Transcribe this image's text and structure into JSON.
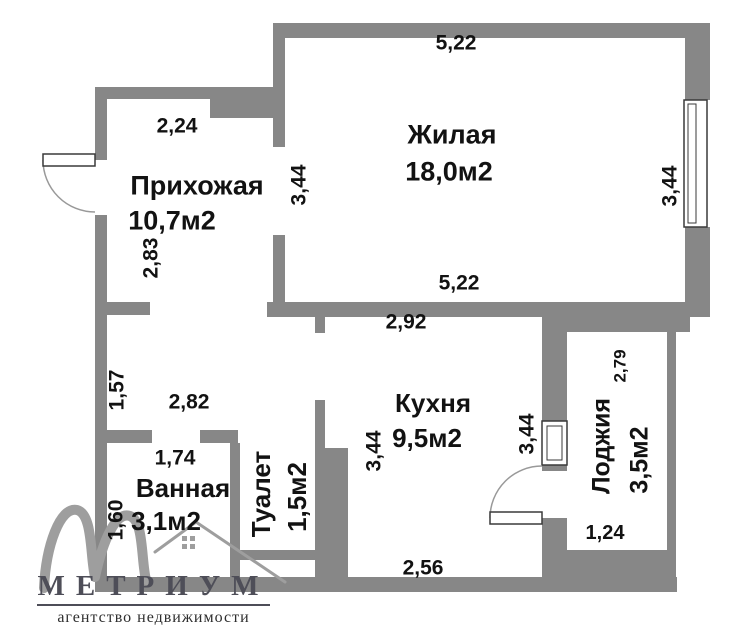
{
  "colors": {
    "wall": "#878787",
    "text": "#121212",
    "frame": "#3a3a3a",
    "arc": "#999999",
    "logo_mark": "#9e9e9e",
    "logo_text": "#4e4e58",
    "tagline": "#2e2e2e"
  },
  "rooms": {
    "living": {
      "name": "Жилая",
      "area": "18,0м2"
    },
    "hallway": {
      "name": "Прихожая",
      "area": "10,7м2"
    },
    "kitchen": {
      "name": "Кухня",
      "area": "9,5м2"
    },
    "bathroom": {
      "name": "Ванная",
      "area": "3,1м2"
    },
    "toilet": {
      "name": "Туалет",
      "area": "1,5м2"
    },
    "loggia": {
      "name": "Лоджия",
      "area": "3,5м2"
    }
  },
  "dims": {
    "living_top": "5,22",
    "living_bottom": "5,22",
    "living_right": "3,44",
    "living_left_opening": "3,44",
    "hallway_top": "2,24",
    "hallway_left": "2,83",
    "hall_height": "1,57",
    "hall_width": "2,82",
    "bathroom_top": "1,74",
    "bathroom_left": "1,60",
    "kitchen_top": "2,92",
    "kitchen_left": "3,44",
    "kitchen_right": "3,44",
    "kitchen_bottom": "2,56",
    "loggia_side": "2,79",
    "loggia_bottom": "1,24"
  },
  "logo": {
    "brand": "МЕТРИУМ",
    "tagline": "агентство недвижимости"
  }
}
